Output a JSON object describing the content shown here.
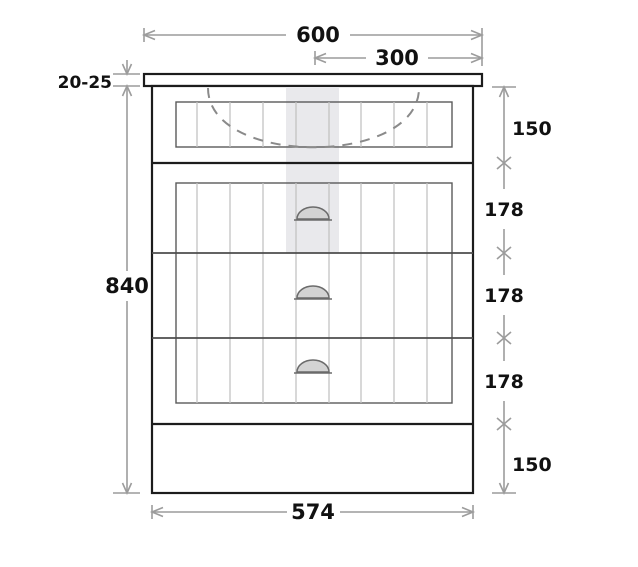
{
  "drawing": {
    "kind": "vanity-cabinet-front-elevation",
    "dims": {
      "overall_width": "600",
      "center_width": "300",
      "worktop_thickness": "20-25",
      "overall_height": "840",
      "apron_height": "150",
      "drawer1_height": "178",
      "drawer2_height": "178",
      "drawer3_height": "178",
      "plinth_height": "150",
      "carcass_width": "574"
    },
    "colors": {
      "line_dark": "#1c1c1c",
      "line_mid": "#5a5a5a",
      "bead_gray": "#c2c2c2",
      "dim_gray": "#9c9c9c",
      "text": "#111111",
      "highlight_strip": "#e9e9ec",
      "handle_fill": "#d3d3d3",
      "dash_gray": "#8a8a8a"
    }
  }
}
